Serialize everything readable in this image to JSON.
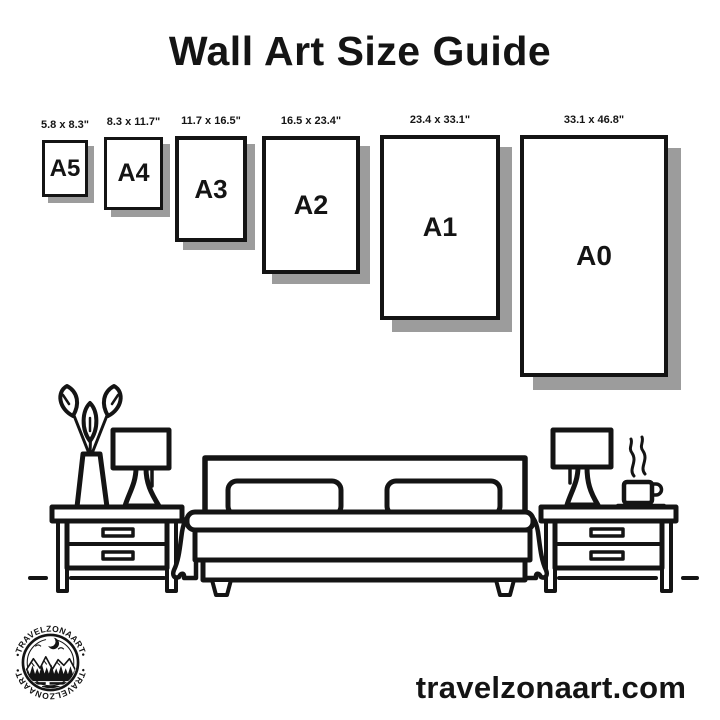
{
  "title": "Wall Art Size Guide",
  "sizes": [
    {
      "name": "A5",
      "dimensions": "5.8 x 8.3\""
    },
    {
      "name": "A4",
      "dimensions": "8.3 x 11.7\""
    },
    {
      "name": "A3",
      "dimensions": "11.7 x 16.5\""
    },
    {
      "name": "A2",
      "dimensions": "16.5 x 23.4\""
    },
    {
      "name": "A1",
      "dimensions": "23.4 x 33.1\""
    },
    {
      "name": "A0",
      "dimensions": "33.1 x 46.8\""
    }
  ],
  "logo": {
    "text_top": "•TRAVELZONAART•",
    "text_bottom": "•TRAVELZONAART•"
  },
  "footer": {
    "website": "travelzonaart.com"
  },
  "colors": {
    "ink": "#141414",
    "shadow": "#9c9c9c",
    "background": "#ffffff"
  }
}
